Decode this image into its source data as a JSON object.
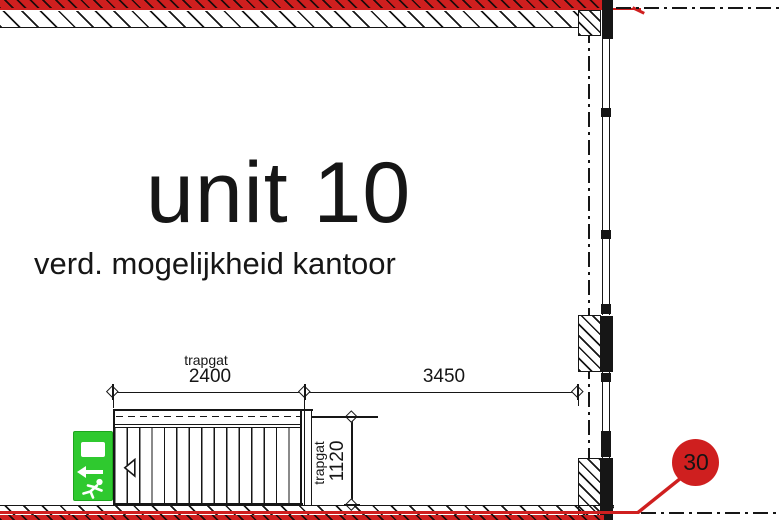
{
  "drawing": {
    "unit_title": "unit 10",
    "unit_subtitle": "verd. mogelijkheid kantoor"
  },
  "dimensions": {
    "top": {
      "label": "trapgat",
      "value": "2400"
    },
    "right": {
      "value": "3450"
    },
    "side": {
      "label": "trapgat",
      "value": "1120"
    }
  },
  "marker": {
    "number": "30"
  },
  "colors": {
    "red": "#cf1f1f",
    "green": "#2fc92f",
    "ink": "#161616"
  },
  "icons": {
    "exit_sign": "exit-running-man-sign",
    "exit_arrow": "arrow-left",
    "exit_door": "door-panel",
    "stair_direction": "triangle-left"
  }
}
